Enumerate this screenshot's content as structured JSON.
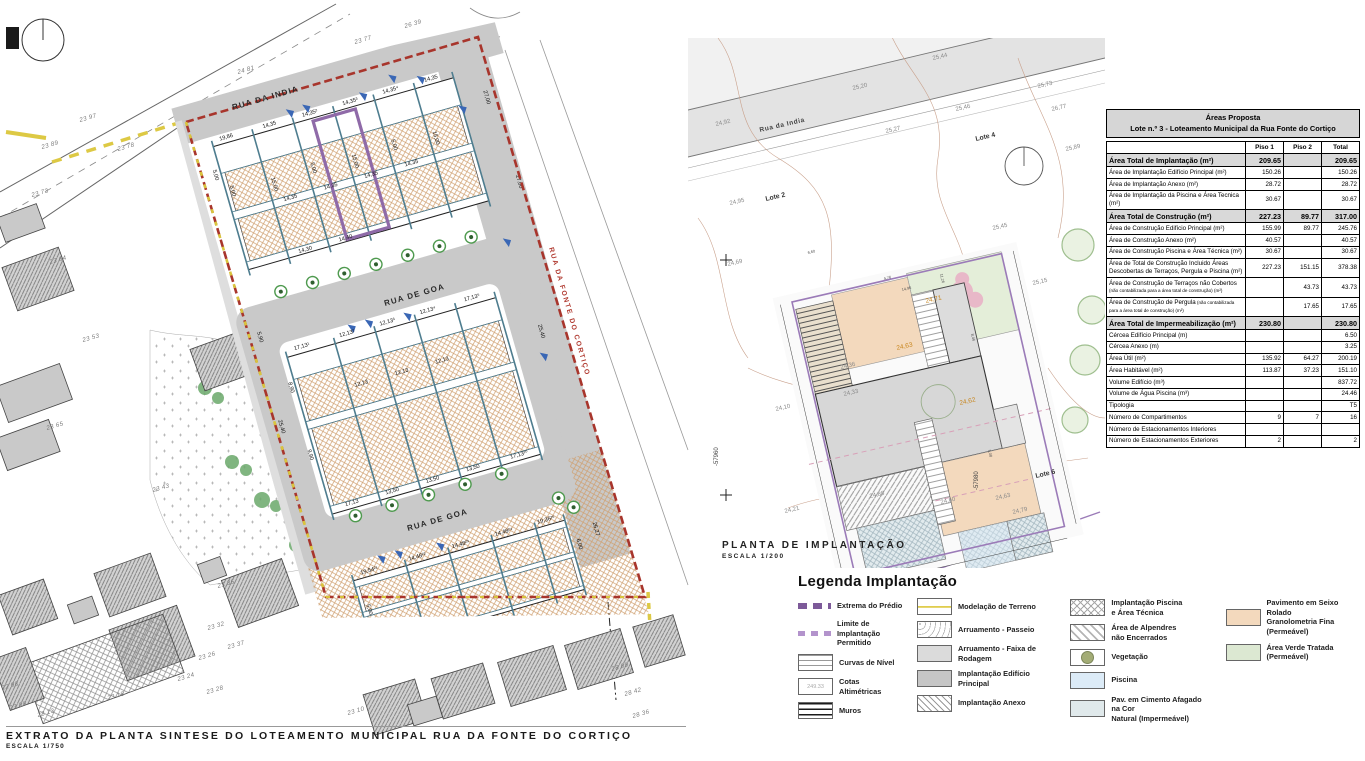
{
  "left_plan": {
    "streets": [
      {
        "t": "RUA DA INDIA",
        "x": 233,
        "y": 110,
        "rot": -16,
        "cls": "st"
      },
      {
        "t": "RUA DE GOA",
        "x": 385,
        "y": 306,
        "rot": -16,
        "cls": "st"
      },
      {
        "t": "RUA DE GOA",
        "x": 408,
        "y": 531,
        "rot": -16,
        "cls": "st"
      },
      {
        "t": "RUA DA FONTE DO CORTIÇO",
        "x": 549,
        "y": 248,
        "rot": 74,
        "cls": "st-red"
      }
    ],
    "elevations": [
      {
        "t": "24 81",
        "x": 238,
        "y": 74
      },
      {
        "t": "23 77",
        "x": 355,
        "y": 44
      },
      {
        "t": "26 39",
        "x": 405,
        "y": 28
      },
      {
        "t": "23 97",
        "x": 80,
        "y": 122
      },
      {
        "t": "23 89",
        "x": 42,
        "y": 149
      },
      {
        "t": "23 78",
        "x": 118,
        "y": 151
      },
      {
        "t": "23 73",
        "x": 32,
        "y": 197
      },
      {
        "t": "23 64",
        "x": 50,
        "y": 264
      },
      {
        "t": "23 53",
        "x": 83,
        "y": 342
      },
      {
        "t": "23 65",
        "x": 47,
        "y": 430
      },
      {
        "t": "23 43",
        "x": 153,
        "y": 492
      },
      {
        "t": "22 98",
        "x": 2,
        "y": 690
      },
      {
        "t": "23 09",
        "x": 10,
        "y": 710
      },
      {
        "t": "23 13",
        "x": 38,
        "y": 717
      },
      {
        "t": "23 18",
        "x": 108,
        "y": 700
      },
      {
        "t": "23 24",
        "x": 178,
        "y": 681
      },
      {
        "t": "23 26",
        "x": 199,
        "y": 660
      },
      {
        "t": "23 28",
        "x": 207,
        "y": 694
      },
      {
        "t": "23 32",
        "x": 208,
        "y": 630
      },
      {
        "t": "23 35",
        "x": 218,
        "y": 588
      },
      {
        "t": "23 37",
        "x": 228,
        "y": 649
      },
      {
        "t": "23 10",
        "x": 348,
        "y": 715
      },
      {
        "t": "28 09",
        "x": 612,
        "y": 671
      },
      {
        "t": "28 42",
        "x": 625,
        "y": 696
      },
      {
        "t": "28 36",
        "x": 633,
        "y": 718
      }
    ],
    "site_dims": [
      {
        "t": "19,86",
        "x": 30,
        "y": 28
      },
      {
        "t": "14,35",
        "x": 75,
        "y": 28
      },
      {
        "t": "14,35²",
        "x": 117,
        "y": 28
      },
      {
        "t": "14,35³",
        "x": 159,
        "y": 28
      },
      {
        "t": "14,35⁴",
        "x": 201,
        "y": 28
      },
      {
        "t": "14,35",
        "x": 243,
        "y": 28
      },
      {
        "t": "14,35",
        "x": 75,
        "y": 104
      },
      {
        "t": "14,35",
        "x": 117,
        "y": 104
      },
      {
        "t": "14,35",
        "x": 159,
        "y": 104
      },
      {
        "t": "14,35",
        "x": 201,
        "y": 104
      },
      {
        "t": "14,30",
        "x": 75,
        "y": 158
      },
      {
        "t": "14,40",
        "x": 117,
        "y": 158
      },
      {
        "t": "5,00",
        "x": 20,
        "y": 80,
        "r": 90
      },
      {
        "t": "15,00",
        "x": 62,
        "y": 85,
        "r": 90
      },
      {
        "t": "5,00",
        "x": 104,
        "y": 80,
        "r": 90
      },
      {
        "t": "15,00",
        "x": 146,
        "y": 85,
        "r": 90
      },
      {
        "t": "5,00",
        "x": 188,
        "y": 80,
        "r": 90
      },
      {
        "t": "15,00",
        "x": 230,
        "y": 85,
        "r": 90
      },
      {
        "t": "27,00",
        "x": 290,
        "y": 60,
        "r": 90
      },
      {
        "t": "27,00",
        "x": 298,
        "y": 150,
        "r": 90
      },
      {
        "t": "17,13¹",
        "x": 45,
        "y": 250
      },
      {
        "t": "12,13²",
        "x": 92,
        "y": 250
      },
      {
        "t": "12,13³",
        "x": 134,
        "y": 250
      },
      {
        "t": "12,13⁴",
        "x": 176,
        "y": 250
      },
      {
        "t": "17,13⁵",
        "x": 222,
        "y": 250
      },
      {
        "t": "12,13",
        "x": 92,
        "y": 302
      },
      {
        "t": "12,13",
        "x": 134,
        "y": 302
      },
      {
        "t": "12,13",
        "x": 176,
        "y": 302
      },
      {
        "t": "17,13",
        "x": 50,
        "y": 414
      },
      {
        "t": "13,50",
        "x": 92,
        "y": 414
      },
      {
        "t": "13,50",
        "x": 134,
        "y": 414
      },
      {
        "t": "13,50",
        "x": 176,
        "y": 414
      },
      {
        "t": "17,13²⁰",
        "x": 224,
        "y": 414
      },
      {
        "t": "8,90",
        "x": 22,
        "y": 285,
        "r": 90
      },
      {
        "t": "9,90",
        "x": 22,
        "y": 355,
        "r": 90
      },
      {
        "t": "5,90",
        "x": 6,
        "y": 228,
        "r": 90
      },
      {
        "t": "25,40",
        "x": 278,
        "y": 300,
        "r": 90
      },
      {
        "t": "25,40",
        "x": 2,
        "y": 320,
        "r": 90
      },
      {
        "t": "19,54²¹",
        "x": 48,
        "y": 484
      },
      {
        "t": "14,48²²",
        "x": 98,
        "y": 484
      },
      {
        "t": "14,48²³",
        "x": 143,
        "y": 484
      },
      {
        "t": "14,48²⁴",
        "x": 188,
        "y": 484
      },
      {
        "t": "19,36²⁵",
        "x": 232,
        "y": 484
      },
      {
        "t": "14,48",
        "x": 60,
        "y": 548
      },
      {
        "t": "5,00",
        "x": 36,
        "y": 520,
        "r": 90
      },
      {
        "t": "6,00",
        "x": 256,
        "y": 515,
        "r": 90
      },
      {
        "t": "26,27",
        "x": 276,
        "y": 505,
        "r": 90
      },
      {
        "t": "5,00",
        "x": 8,
        "y": 60,
        "r": 90
      }
    ],
    "title": "EXTRATO DA PLANTA SINTESE DO LOTEAMENTO MUNICIPAL RUA DA FONTE DO CORTIÇO",
    "scale": "ESCALA 1/750"
  },
  "center_plan": {
    "title": "PLANTA DE IMPLANTAÇÃO",
    "scale": "ESCALA 1/200",
    "street": {
      "t": "Rua da India",
      "x": 72,
      "y": 94,
      "rot": -13
    },
    "contours": [
      {
        "t": "25,44",
        "x": 245,
        "y": 22
      },
      {
        "t": "25,20",
        "x": 165,
        "y": 52
      },
      {
        "t": "24,92",
        "x": 28,
        "y": 88
      },
      {
        "t": "25,73",
        "x": 350,
        "y": 50
      },
      {
        "t": "25,46",
        "x": 268,
        "y": 73
      },
      {
        "t": "26,77",
        "x": 364,
        "y": 73
      },
      {
        "t": "25,89",
        "x": 378,
        "y": 113
      },
      {
        "t": "25,27",
        "x": 198,
        "y": 95
      },
      {
        "t": "24,95",
        "x": 42,
        "y": 167
      },
      {
        "t": "24,69",
        "x": 40,
        "y": 228
      },
      {
        "t": "25,45",
        "x": 305,
        "y": 192
      },
      {
        "t": "25,15",
        "x": 345,
        "y": 247
      },
      {
        "t": "24,36",
        "x": 153,
        "y": 331
      },
      {
        "t": "24,33",
        "x": 156,
        "y": 358
      },
      {
        "t": "24,10",
        "x": 88,
        "y": 373
      },
      {
        "t": "24,21",
        "x": 97,
        "y": 475
      },
      {
        "t": "24,88",
        "x": 182,
        "y": 460
      },
      {
        "t": "24,60",
        "x": 253,
        "y": 466
      },
      {
        "t": "24,79",
        "x": 325,
        "y": 476
      },
      {
        "t": "24,63",
        "x": 308,
        "y": 462
      }
    ],
    "zone_labels": [
      {
        "t": "24,71",
        "x": 238,
        "y": 265
      },
      {
        "t": "24,63",
        "x": 209,
        "y": 312
      },
      {
        "t": "24,62",
        "x": 272,
        "y": 367
      }
    ],
    "lotes": [
      {
        "t": "Lote 2",
        "x": 78,
        "y": 163
      },
      {
        "t": "Lote 4",
        "x": 288,
        "y": 103
      },
      {
        "t": "Lote 6",
        "x": 348,
        "y": 440
      }
    ],
    "coords": [
      {
        "t": "-57960",
        "x": 30,
        "y": 428
      },
      {
        "t": "-57980",
        "x": 290,
        "y": 452
      }
    ],
    "small_dims": [
      {
        "t": "4,76",
        "x": 196,
        "y": 242,
        "r": -13
      },
      {
        "t": "14,96",
        "x": 214,
        "y": 253,
        "r": -13
      },
      {
        "t": "11,26",
        "x": 252,
        "y": 236,
        "r": 77
      },
      {
        "t": "8,46",
        "x": 283,
        "y": 296,
        "r": 77
      },
      {
        "t": "6,60",
        "x": 120,
        "y": 216,
        "r": -13
      },
      {
        "t": "5,08",
        "x": 300,
        "y": 412,
        "r": 77
      }
    ]
  },
  "areas_table": {
    "title_line1": "Áreas Proposta",
    "title_line2": "Lote n.º 3 - Loteamento Municipal da Rua Fonte do Cortiço",
    "columns": [
      "Piso 1",
      "Piso 2",
      "Total"
    ],
    "rows": [
      {
        "label": "Área Total de Implantação (m²)",
        "p1": "209.65",
        "p2": "",
        "t": "209.65",
        "sec": true
      },
      {
        "label": "Área de Implantação Edifício Principal (m²)",
        "p1": "150.26",
        "p2": "",
        "t": "150.26"
      },
      {
        "label": "Área de Implantação Anexo (m²)",
        "p1": "28.72",
        "p2": "",
        "t": "28.72"
      },
      {
        "label": "Área de Implantação da Piscina e Área Tecnica (m²)",
        "p1": "30.67",
        "p2": "",
        "t": "30.67"
      },
      {
        "label": "Área Total de Construção (m²)",
        "p1": "227.23",
        "p2": "89.77",
        "t": "317.00",
        "sec": true
      },
      {
        "label": "Área de Construção Edifício Principal (m²)",
        "p1": "155.99",
        "p2": "89.77",
        "t": "245.76"
      },
      {
        "label": "Área de Construção Anexo (m²)",
        "p1": "40.57",
        "p2": "",
        "t": "40.57"
      },
      {
        "label": "Área de Construção Piscina e Área Técnica (m²)",
        "p1": "30.67",
        "p2": "",
        "t": "30.67"
      },
      {
        "label": "Área de Total de Construção Incluido Áreas Descobertas de Terraços, Pergula e Piscina (m²)",
        "p1": "227.23",
        "p2": "151.15",
        "t": "378.38"
      },
      {
        "label": "Área de Construção de Terraços não Cobertos",
        "note": "(não contabilizada para a área total de construção) (m²)",
        "p1": "",
        "p2": "43.73",
        "t": "43.73"
      },
      {
        "label": "Área de Construção de Pergula",
        "note": "(não contabilizada para a área total de construção) (m²)",
        "p1": "",
        "p2": "17.65",
        "t": "17.65"
      },
      {
        "label": "Área Total de Impermeabilização (m²)",
        "p1": "230.80",
        "p2": "",
        "t": "230.80",
        "sec": true
      },
      {
        "label": "Cércea Edifício Principal (m)",
        "p1": "",
        "p2": "",
        "t": "6.50"
      },
      {
        "label": "Cércea Anexo (m)",
        "p1": "",
        "p2": "",
        "t": "3.25"
      },
      {
        "label": "Área Útil (m²)",
        "p1": "135.92",
        "p2": "64.27",
        "t": "200.19"
      },
      {
        "label": "Área Habitável (m²)",
        "p1": "113.87",
        "p2": "37.23",
        "t": "151.10"
      },
      {
        "label": "Volume Edifício (m³)",
        "p1": "",
        "p2": "",
        "t": "837.72"
      },
      {
        "label": "Volume de Água Piscina (m³)",
        "p1": "",
        "p2": "",
        "t": "24.46"
      },
      {
        "label": "Tipologia",
        "p1": "",
        "p2": "",
        "t": "T5"
      },
      {
        "label": "Número de Compartimentos",
        "p1": "9",
        "p2": "7",
        "t": "16"
      },
      {
        "label": "Número de Estacionamentos Interiores",
        "p1": "",
        "p2": "",
        "t": ""
      },
      {
        "label": "Número de Estacionamentos Exteriores",
        "p1": "2",
        "p2": "",
        "t": "2"
      }
    ]
  },
  "legend": {
    "title": "Legenda Implantação",
    "columns": [
      [
        {
          "sw": "extrema",
          "label": "Extrema do Prédio"
        },
        {
          "sw": "limite",
          "label": "Limite de Implantação\nPermitido"
        },
        {
          "sw": "curvas",
          "label": "Curvas de Nível"
        },
        {
          "sw": "cotas",
          "label": "Cotas Altimétricas",
          "swatch_text": "249.33"
        },
        {
          "sw": "muros",
          "label": "Muros"
        }
      ],
      [
        {
          "sw": "modelacao",
          "label": "Modelação de Terreno"
        },
        {
          "sw": "passeio",
          "label": "Arruamento - Passeio"
        },
        {
          "sw": "faixa",
          "label": "Arruamento - Faixa de Rodagem"
        },
        {
          "sw": "edificio",
          "label": "Implantação  Edifício\nPrincipal"
        },
        {
          "sw": "anexo",
          "label": "Implantação Anexo"
        }
      ],
      [
        {
          "sw": "piscina-tecnica",
          "label": "Implantação Piscina\ne Área Técnica"
        },
        {
          "sw": "alpendres",
          "label": "Área de Alpendres\nnão Encerrados"
        },
        {
          "sw": "vegetacao",
          "label": "Vegetação"
        },
        {
          "sw": "piscina",
          "label": "Piscina"
        },
        {
          "sw": "cimento",
          "label": "Pav. em Cimento Afagado na Cor\nNatural (Impermeável)"
        }
      ],
      [
        {
          "sw": "seixo",
          "label": "Pavimento em Seixo Rolado\nGranolometria Fina (Permeável)"
        },
        {
          "sw": "verde",
          "label": "Área Verde Tratada (Permeável)"
        }
      ]
    ]
  }
}
